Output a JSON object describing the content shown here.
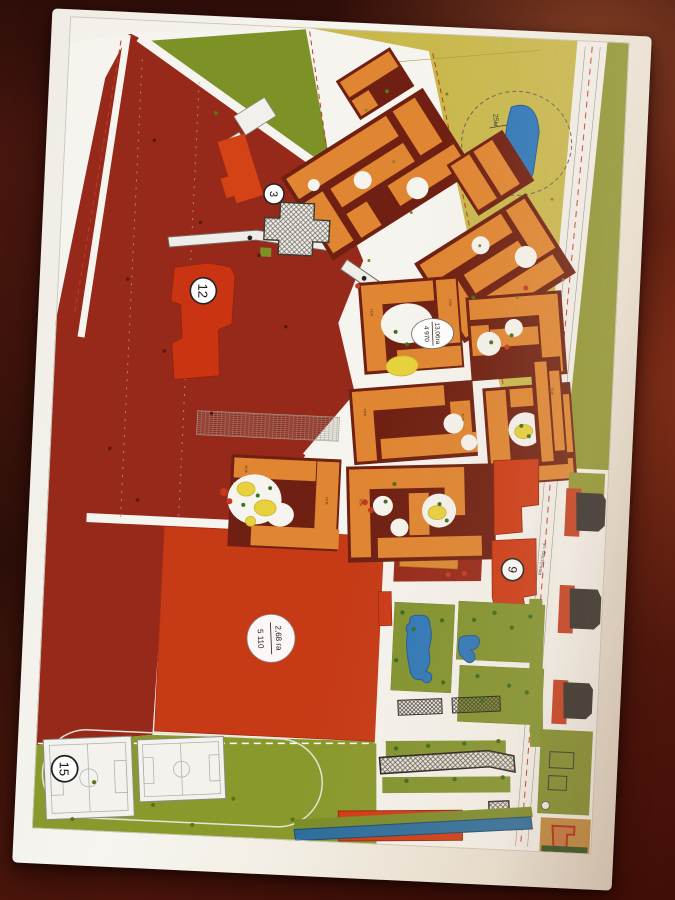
{
  "scene": {
    "surface_colors": {
      "table_dark": "#3a120c",
      "table_light": "#7a3120"
    },
    "paper_color": "#f4f1ea"
  },
  "map": {
    "badges": {
      "school": "3",
      "building_12": "12",
      "building_9": "9",
      "stadium": "15"
    },
    "area_labels": {
      "district": {
        "area": "13,06га",
        "value": "4 970"
      },
      "sports_field": {
        "area": "2,68 га",
        "value": "5 110"
      }
    },
    "pond_dimension": "25м",
    "street_name": "ул. Восточная",
    "building_unit_label": "ТСЖ",
    "legend_colors": {
      "existing_dark_zone": "#97291a",
      "block_maroon": "#6f2012",
      "residential_orange": "#e08632",
      "public_red": "#cf3a16",
      "greenery_olive": "#8a992c",
      "reserve_yellow": "#c9b94d",
      "water_blue": "#2e78ba",
      "playground_yellow": "#e7d23e"
    }
  }
}
